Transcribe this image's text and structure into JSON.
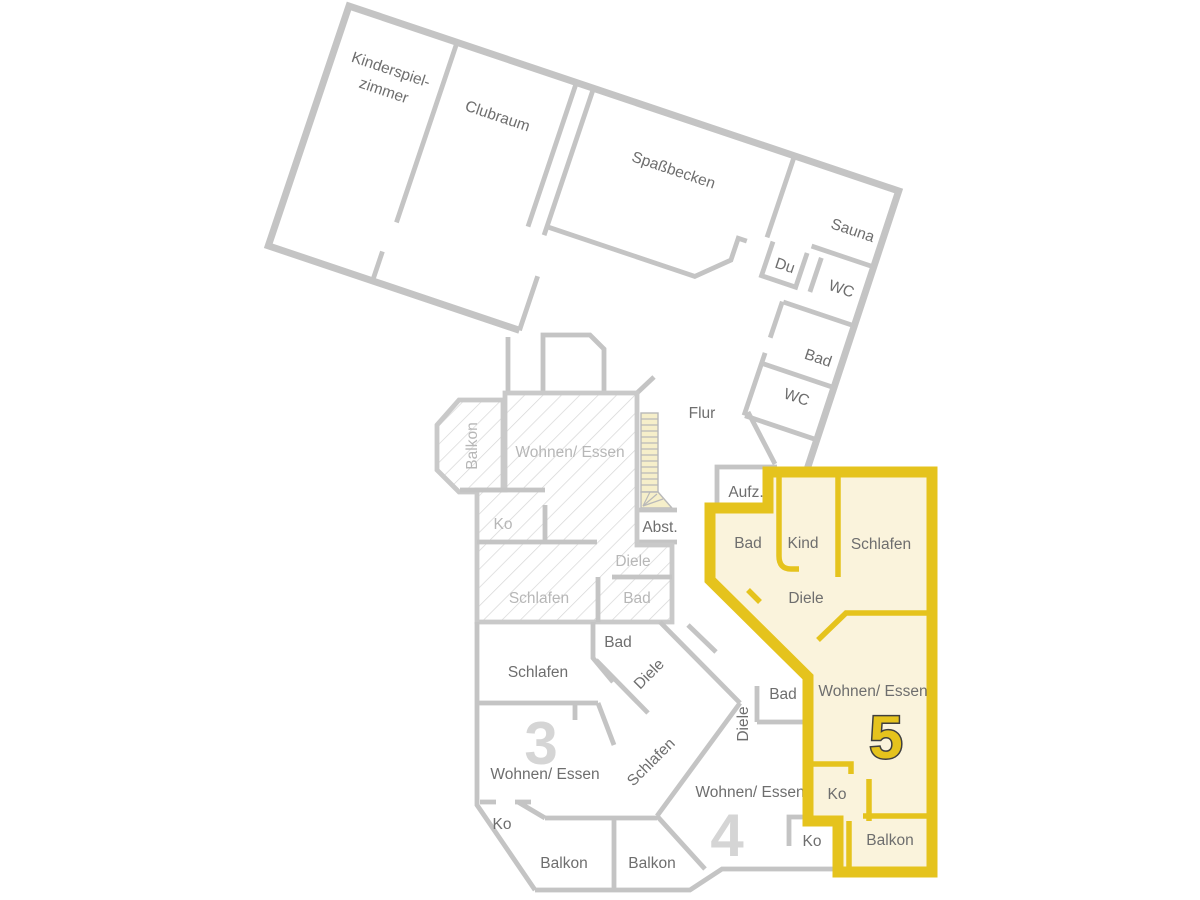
{
  "plan_type": "floor-plan",
  "selected_apartment": "5",
  "colors": {
    "highlight": "#e5c31d",
    "highlight_fill": "#faf3dc",
    "wall": "#c4c4c4",
    "label": "#6e6e6e",
    "label_muted": "#b7b7b7",
    "numeral_muted": "#d5d5d5",
    "numeral_outline": "#3e3e3e",
    "stairs_fill": "#f6efca"
  },
  "labels": {
    "wing": {
      "kinderspielzimmer_1": "Kinderspiel-",
      "kinderspielzimmer_2": "zimmer",
      "clubraum": "Clubraum",
      "spassbecken": "Spaßbecken",
      "sauna": "Sauna",
      "du": "Du",
      "wc_top": "WC",
      "bad": "Bad",
      "wc_bottom": "WC"
    },
    "common": {
      "flur": "Flur",
      "aufzug": "Aufz.",
      "abstell": "Abst."
    },
    "hatched_apartment": {
      "balkon": "Balkon",
      "wohnen_essen": "Wohnen/ Essen",
      "ko": "Ko",
      "schlafen": "Schlafen",
      "diele": "Diele",
      "bad": "Bad"
    },
    "apartment3": {
      "number": "3",
      "schlafen": "Schlafen",
      "bad": "Bad",
      "diele": "Diele",
      "wohnen_essen": "Wohnen/ Essen",
      "ko": "Ko",
      "balkon": "Balkon"
    },
    "apartment4": {
      "number": "4",
      "schlafen": "Schlafen",
      "diele": "Diele",
      "bad": "Bad",
      "wohnen_essen": "Wohnen/ Essen",
      "ko": "Ko",
      "balkon": "Balkon"
    },
    "apartment5": {
      "number": "5",
      "bad": "Bad",
      "kind": "Kind",
      "schlafen": "Schlafen",
      "diele": "Diele",
      "wohnen_essen": "Wohnen/ Essen",
      "ko": "Ko",
      "balkon": "Balkon"
    }
  }
}
